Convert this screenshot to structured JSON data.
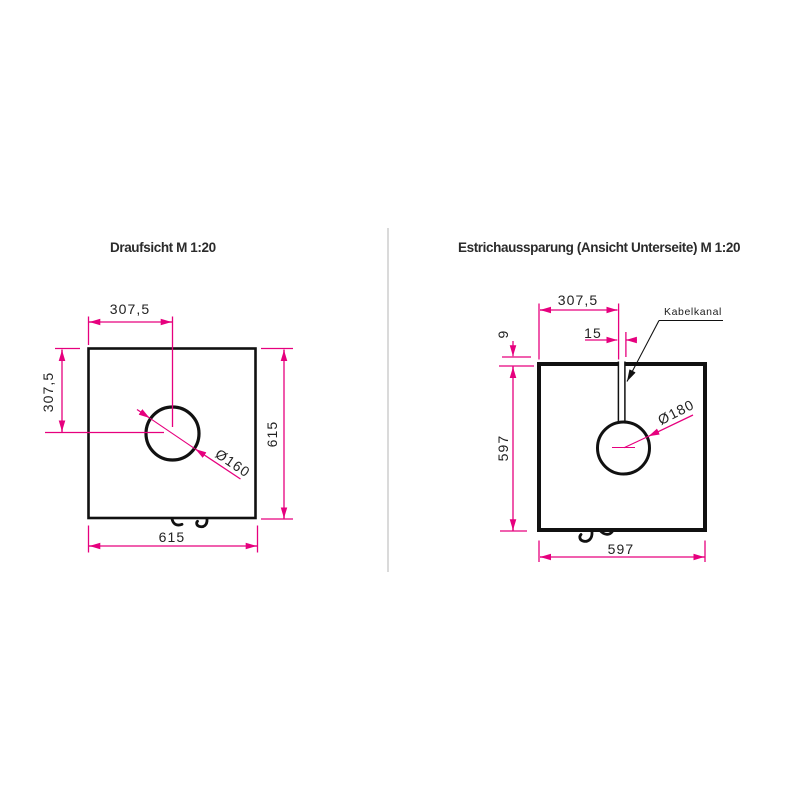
{
  "colors": {
    "dimension": "#E6007E",
    "line": "#111111",
    "text": "#2b2b2b",
    "divider": "#d6d6d6"
  },
  "left_view": {
    "title": "Draufsicht M 1:20",
    "dimensions": {
      "top_width": "307,5",
      "left_height": "307,5",
      "right_height": "615",
      "bottom_width": "615",
      "hole_diameter": "Ø160"
    }
  },
  "right_view": {
    "title": "Estrichaussparung (Ansicht Unterseite) M 1:20",
    "dimensions": {
      "top_width": "307,5",
      "channel_width": "15",
      "edge_offset": "9",
      "left_height": "597",
      "bottom_width": "597",
      "hole_diameter": "Ø180"
    },
    "labels": {
      "cable_channel": "Kabelkanal"
    }
  }
}
